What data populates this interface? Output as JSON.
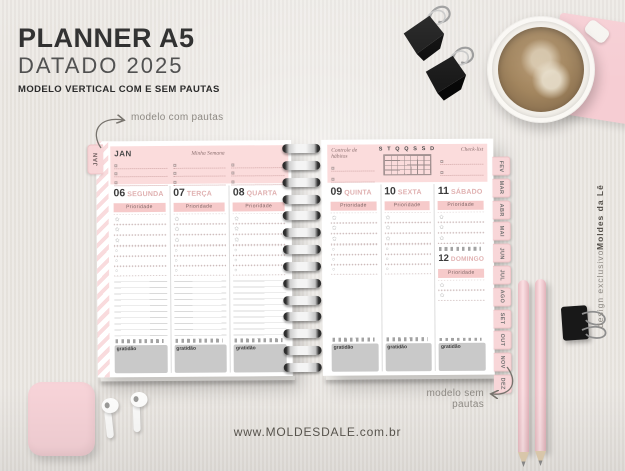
{
  "header": {
    "title": "PLANNER A5",
    "subtitle": "DATADO 2025",
    "tagline": "MODELO VERTICAL COM E SEM PAUTAS"
  },
  "annotations": {
    "with_lines": "modelo com pautas",
    "without_lines": "modelo sem pautas"
  },
  "footer": {
    "website": "www.MOLDESDALE.com.br"
  },
  "credit": {
    "prefix": "design exclusivo ",
    "brand": "Moldes da Lê"
  },
  "planner": {
    "side_tab": "JAN",
    "priority_label": "Prioridade",
    "gratitude_label": "gratidão",
    "left_page": {
      "month": "JAN",
      "script_title": "Minha Semana",
      "days": [
        {
          "num": "06",
          "name": "SEGUNDA"
        },
        {
          "num": "07",
          "name": "TERÇA"
        },
        {
          "num": "08",
          "name": "QUARTA"
        }
      ]
    },
    "right_page": {
      "script_left": "Controle de hábitos",
      "week_letters": "S T Q Q S S D",
      "script_right": "Check-list",
      "days": [
        {
          "num": "09",
          "name": "QUINTA"
        },
        {
          "num": "10",
          "name": "SEXTA"
        },
        {
          "num": "11",
          "name": "SÁBADO"
        },
        {
          "num": "12",
          "name": "DOMINGO"
        }
      ]
    },
    "month_tabs": [
      "FEV",
      "MAR",
      "ABR",
      "MAI",
      "JUN",
      "JUL",
      "AGO",
      "SET",
      "OUT",
      "NOV",
      "DEZ"
    ]
  },
  "colors": {
    "background": "#e9e5e0",
    "pink_accent": "#f8d6d8",
    "pink_band": "#fbdcdc",
    "priority_bar": "#f6caca",
    "gray_box": "#c9c9c9",
    "text_dark": "#262626"
  }
}
